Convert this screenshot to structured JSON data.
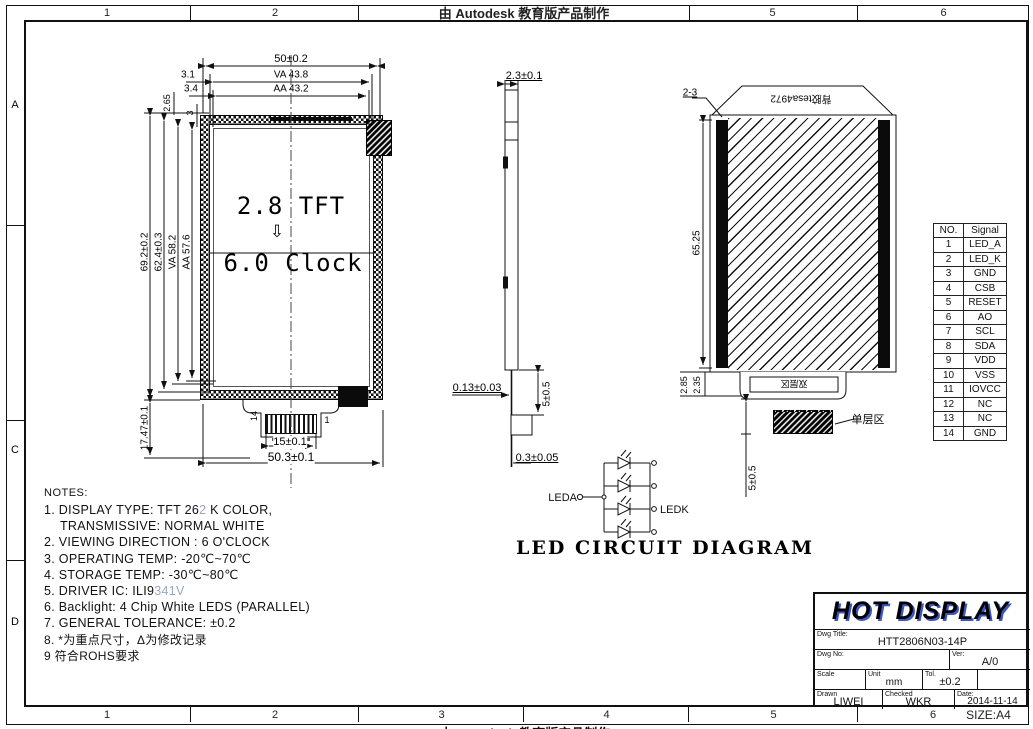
{
  "frame": {
    "top_cells": [
      "1",
      "2",
      "5",
      "6"
    ],
    "autodesk_stamp": "由 Autodesk 教育版产品制作",
    "bottom_cells": [
      "1",
      "2",
      "3",
      "4",
      "5",
      "6"
    ],
    "row_labels": [
      "A",
      "",
      "C",
      "D"
    ],
    "size_label": "SIZE:A4"
  },
  "front_view": {
    "center_line1": "2.8 TFT",
    "center_line2": "6.0 Clock",
    "pin_first": "1",
    "pin_last": "14",
    "dims": {
      "width_total": "50±0.2",
      "width_va": "VA 43.8",
      "width_aa": "AA 43.2",
      "off_31": "3.1",
      "off_34": "3.4",
      "off_265": "2.65",
      "off_3": "3",
      "height_total": "69.2±0.2",
      "height_62": "62.4±0.3",
      "height_va": "VA 58.2",
      "height_aa": "AA 57.6",
      "tail": "17.47±0.1",
      "conn_w": "15±0.1",
      "bottom_w": "50.3±0.1"
    }
  },
  "side_view": {
    "dims": {
      "thickness": "2.3±0.1",
      "fpc": "0.13±0.03",
      "tail": "5±0.5",
      "tip": "0.3±0.05"
    }
  },
  "back_view": {
    "corner": "2-3",
    "tape": "背胶tesa4972",
    "inner_label": "双层区",
    "single_label": "单层区",
    "dims": {
      "height": "65.25",
      "s1": "2.85",
      "s2": "2.35",
      "tail": "5±0.5"
    }
  },
  "pin_table": {
    "headers": [
      "NO.",
      "Signal"
    ],
    "rows": [
      [
        "1",
        "LED_A"
      ],
      [
        "2",
        "LED_K"
      ],
      [
        "3",
        "GND"
      ],
      [
        "4",
        "CSB"
      ],
      [
        "5",
        "RESET"
      ],
      [
        "6",
        "AO"
      ],
      [
        "7",
        "SCL"
      ],
      [
        "8",
        "SDA"
      ],
      [
        "9",
        "VDD"
      ],
      [
        "10",
        "VSS"
      ],
      [
        "11",
        "IOVCC"
      ],
      [
        "12",
        "NC"
      ],
      [
        "13",
        "NC"
      ],
      [
        "14",
        "GND"
      ]
    ]
  },
  "led": {
    "anode": "LEDA",
    "cathode": "LEDK",
    "caption": "LED  CIRCUIT  DIAGRAM"
  },
  "notes": {
    "title": "NOTES:",
    "lines": [
      {
        "parts": [
          {
            "t": "1. DISPLAY TYPE: TFT 26"
          },
          {
            "t": "2",
            "light": true
          },
          {
            "t": " K COLOR,"
          }
        ]
      },
      {
        "indent": true,
        "parts": [
          {
            "t": "TRANSMISSIVE: NORMAL WHITE"
          }
        ]
      },
      {
        "parts": [
          {
            "t": "2. VIEWING DIRECTION : 6 O'CLOCK"
          }
        ]
      },
      {
        "parts": [
          {
            "t": "3. OPERATING TEMP: -20℃~70℃"
          }
        ]
      },
      {
        "parts": [
          {
            "t": "4. STORAGE TEMP: -30℃~80℃"
          }
        ]
      },
      {
        "parts": [
          {
            "t": "5. DRIVER IC: ILI9"
          },
          {
            "t": "341V",
            "light": true
          }
        ]
      },
      {
        "parts": [
          {
            "t": "6. Backlight: 4 Chip White LEDS (PARALLEL)"
          }
        ]
      },
      {
        "parts": [
          {
            "t": "7. GENERAL TOLERANCE: ±0.2"
          }
        ]
      },
      {
        "cjk": true,
        "parts": [
          {
            "t": "8. *为重点尺寸，Δ为修改记录"
          }
        ]
      },
      {
        "cjk": true,
        "parts": [
          {
            "t": "9   符合ROHS要求"
          }
        ]
      }
    ]
  },
  "title_block": {
    "company": "HOT DISPLAY",
    "dwg_title_label": "Dwg Title:",
    "dwg_title": "HTT2806N03-14P",
    "dwg_no_label": "Dwg No:",
    "ver_label": "Ver:",
    "ver": "A/0",
    "scale_label": "Scale",
    "unit_label": "Unit",
    "unit": "mm",
    "tol_label": "Tol.",
    "tol": "±0.2",
    "drawn_label": "Drawn",
    "drawn": "LIWEI",
    "checked_label": "Checked",
    "checked": "WKR",
    "date_label": "Date:",
    "date": "2014-11-14"
  },
  "colors": {
    "accent_blue": "#3c55c4",
    "revision_light": "#97a8bf",
    "line": "#111111"
  }
}
